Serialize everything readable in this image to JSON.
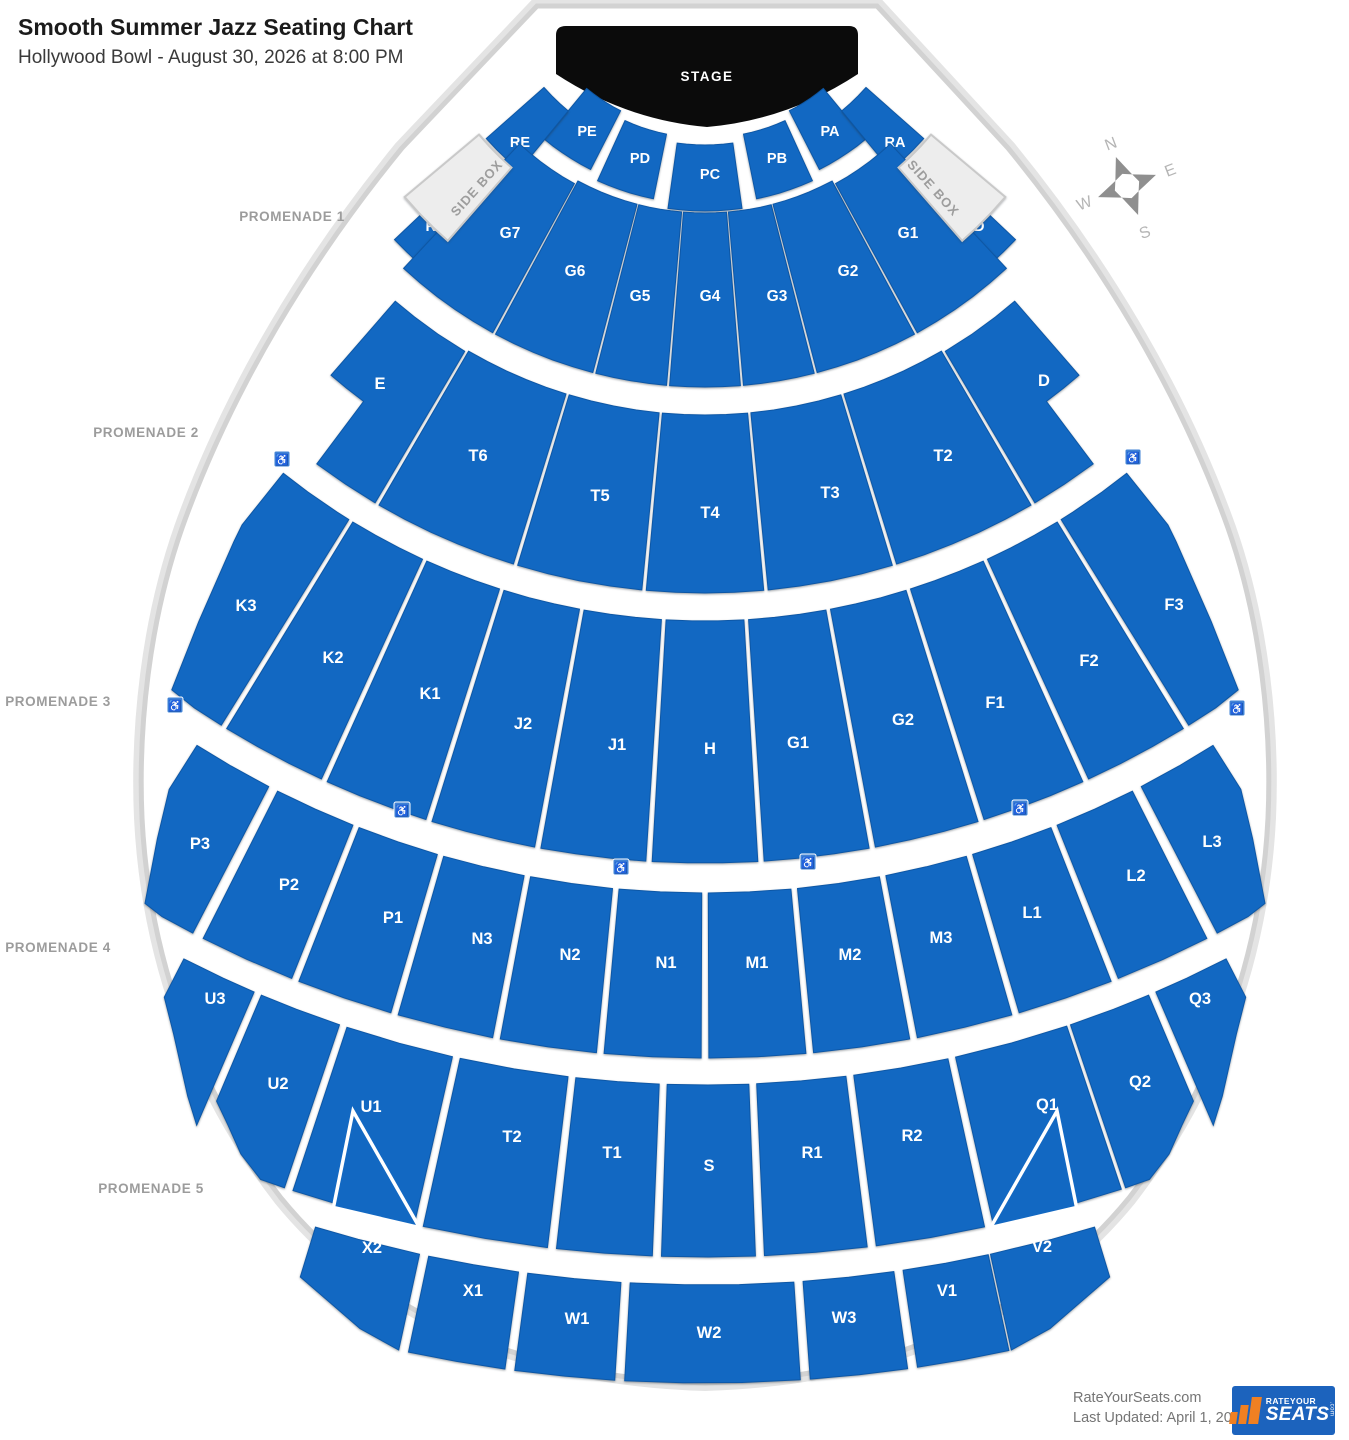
{
  "header": {
    "title": "Smooth Summer Jazz Seating Chart",
    "subtitle": "Hollywood Bowl - August 30, 2026 at 8:00 PM"
  },
  "stage": {
    "label": "STAGE"
  },
  "colors": {
    "section_blue": "#1268c2",
    "section_stroke": "#0d57a6",
    "shell_stroke": "#d2d2d2",
    "sidebox_fill": "#ededed",
    "label_white": "#ffffff",
    "promenade_text": "#9c9c9c",
    "accessible_blue": "#4083d6",
    "stage_black": "#0b0b0b",
    "logo_blue": "#1c63bd",
    "logo_orange": "#f08022"
  },
  "geometry": {
    "cx": 705,
    "cy": -55
  },
  "promenades": [
    {
      "label": "PROMENADE 1",
      "x": 292,
      "y": 221
    },
    {
      "label": "PROMENADE 2",
      "x": 146,
      "y": 437
    },
    {
      "label": "PROMENADE 3",
      "x": 58,
      "y": 706
    },
    {
      "label": "PROMENADE 4",
      "x": 58,
      "y": 952
    },
    {
      "label": "PROMENADE 5",
      "x": 151,
      "y": 1193
    }
  ],
  "compass": {
    "x": 1127,
    "y": 186,
    "rotation": -21,
    "letters": {
      "n": "N",
      "e": "E",
      "s": "S",
      "w": "W"
    }
  },
  "footer": {
    "site": "RateYourSeats.com",
    "updated": "Last Updated: April 1, 2026",
    "logo": {
      "top": "RATEYOUR",
      "main": "SEATS",
      "com": ".com"
    }
  },
  "side_boxes": [
    {
      "name": "side-box-left",
      "label": "SIDE BOX",
      "t0": 50,
      "t1": 41,
      "r0": 295,
      "r1": 392,
      "lx": 480,
      "ly": 191,
      "rot": -48
    },
    {
      "name": "side-box-right",
      "label": "SIDE BOX",
      "t0": -41,
      "t1": -50,
      "r0": 295,
      "r1": 392,
      "lx": 930,
      "ly": 191,
      "rot": 48
    }
  ],
  "sections": [
    {
      "name": "PE",
      "label": "PE",
      "t0": 39.5,
      "t1": 27,
      "r0": 186,
      "r1": 252,
      "lx": 587,
      "ly": 136,
      "fs": 14.5
    },
    {
      "name": "PD",
      "label": "PD",
      "t0": 24.5,
      "t1": 11.5,
      "r0": 193,
      "r1": 259,
      "lx": 640,
      "ly": 163,
      "fs": 14.5
    },
    {
      "name": "PC",
      "label": "PC",
      "t0": 8,
      "t1": -8,
      "r0": 200,
      "r1": 266,
      "lx": 710,
      "ly": 179,
      "fs": 14.5
    },
    {
      "name": "PB",
      "label": "PB",
      "t0": -11.5,
      "t1": -24.5,
      "r0": 193,
      "r1": 259,
      "lx": 777,
      "ly": 163,
      "fs": 14.5
    },
    {
      "name": "PA",
      "label": "PA",
      "t0": -27,
      "t1": -39.5,
      "r0": 186,
      "r1": 252,
      "lx": 830,
      "ly": 136,
      "fs": 14.5
    },
    {
      "name": "RE",
      "label": "RE",
      "t0": 48.5,
      "t1": 39.5,
      "r0": 215,
      "r1": 292,
      "lx": 520,
      "ly": 147,
      "fs": 14.5
    },
    {
      "name": "RA",
      "label": "RA",
      "t0": -39.5,
      "t1": -48.5,
      "r0": 215,
      "r1": 292,
      "lx": 895,
      "ly": 147,
      "fs": 14.5
    },
    {
      "name": "RH",
      "label": "RH",
      "t0": 46.5,
      "t1": 39.5,
      "r0": 372,
      "r1": 428,
      "lx": 436,
      "ly": 231,
      "fs": 14.5
    },
    {
      "name": "RD",
      "label": "RD",
      "t0": -39.5,
      "t1": -46.5,
      "r0": 372,
      "r1": 428,
      "lx": 974,
      "ly": 231,
      "fs": 14.5
    },
    {
      "name": "G7",
      "label": "G7",
      "t0": 43,
      "t1": 28.7,
      "r0": 272,
      "r1": 442,
      "lx": 510,
      "ly": 238,
      "fs": 15.5
    },
    {
      "name": "G6",
      "label": "G6",
      "t0": 28.3,
      "t1": 14.7,
      "r0": 268,
      "r1": 442,
      "lx": 575,
      "ly": 276,
      "fs": 15.5
    },
    {
      "name": "G5",
      "label": "G5",
      "t0": 14.3,
      "t1": 5.0,
      "r0": 268,
      "r1": 442,
      "lx": 640,
      "ly": 301,
      "fs": 15.5
    },
    {
      "name": "G4",
      "label": "G4",
      "t0": 4.6,
      "t1": -4.6,
      "r0": 268,
      "r1": 442,
      "lx": 710,
      "ly": 301,
      "fs": 15.5
    },
    {
      "name": "G3",
      "label": "G3",
      "t0": -5.0,
      "t1": -14.3,
      "r0": 268,
      "r1": 442,
      "lx": 777,
      "ly": 301,
      "fs": 15.5
    },
    {
      "name": "G2",
      "label": "G2",
      "t0": -14.7,
      "t1": -28.3,
      "r0": 268,
      "r1": 442,
      "lx": 848,
      "ly": 276,
      "fs": 15.5
    },
    {
      "name": "G1",
      "label": "G1",
      "t0": -28.7,
      "t1": -43,
      "r0": 272,
      "r1": 442,
      "lx": 908,
      "ly": 238,
      "fs": 15.5
    },
    {
      "name": "E",
      "label": "E",
      "pts": [
        [
          41,
          472
        ],
        [
          38,
          472
        ],
        [
          34.5,
          472
        ],
        [
          30.6,
          472
        ],
        [
          30.6,
          648
        ],
        [
          33.7,
          648
        ],
        [
          36.8,
          648
        ],
        [
          36.8,
          570
        ],
        [
          39,
          570
        ],
        [
          41,
          570
        ]
      ],
      "lx": 380,
      "ly": 389,
      "fs": 16.5
    },
    {
      "name": "T6",
      "label": "T6",
      "t0": 30.2,
      "t1": 17.2,
      "r0": 470,
      "r1": 648,
      "lx": 478,
      "ly": 461,
      "fs": 16.5
    },
    {
      "name": "T5",
      "label": "T5",
      "t0": 16.8,
      "t1": 5.6,
      "r0": 470,
      "r1": 648,
      "lx": 600,
      "ly": 501,
      "fs": 16.5
    },
    {
      "name": "T4",
      "label": "T4",
      "t0": 5.2,
      "t1": -5.2,
      "r0": 470,
      "r1": 648,
      "lx": 710,
      "ly": 518,
      "fs": 16.5
    },
    {
      "name": "T3",
      "label": "T3",
      "t0": -5.6,
      "t1": -16.8,
      "r0": 470,
      "r1": 648,
      "lx": 830,
      "ly": 498,
      "fs": 16.5
    },
    {
      "name": "T2",
      "label": "T2",
      "t0": -17.2,
      "t1": -30.2,
      "r0": 470,
      "r1": 648,
      "lx": 943,
      "ly": 461,
      "fs": 16.5
    },
    {
      "name": "D",
      "label": "D",
      "pts": [
        [
          -30.6,
          472
        ],
        [
          -34.5,
          472
        ],
        [
          -38,
          472
        ],
        [
          -41,
          472
        ],
        [
          -41,
          570
        ],
        [
          -39,
          570
        ],
        [
          -36.8,
          570
        ],
        [
          -36.8,
          648
        ],
        [
          -33.7,
          648
        ],
        [
          -30.6,
          648
        ]
      ],
      "lx": 1044,
      "ly": 386,
      "fs": 16.5
    },
    {
      "name": "K3",
      "label": "K3",
      "pts": [
        [
          38.6,
          676
        ],
        [
          36,
          676
        ],
        [
          33,
          676
        ],
        [
          31.8,
          676
        ],
        [
          31.8,
          918
        ],
        [
          33.8,
          918
        ],
        [
          35.6,
          916
        ],
        [
          36.8,
          845
        ],
        [
          38.3,
          760
        ],
        [
          38.6,
          742
        ]
      ],
      "lx": 246,
      "ly": 611,
      "fs": 16.5
    },
    {
      "name": "K2",
      "label": "K2",
      "t0": 31.4,
      "t1": 24.7,
      "r0": 676,
      "r1": 918,
      "lx": 333,
      "ly": 663,
      "fs": 16.5
    },
    {
      "name": "K1",
      "label": "K1",
      "t0": 24.3,
      "t1": 17.7,
      "r0": 676,
      "r1": 918,
      "lx": 430,
      "ly": 699,
      "fs": 16.5
    },
    {
      "name": "J2",
      "label": "J2",
      "t0": 17.3,
      "t1": 10.7,
      "r0": 676,
      "r1": 918,
      "lx": 523,
      "ly": 729,
      "fs": 16.5
    },
    {
      "name": "J1",
      "label": "J1",
      "t0": 10.3,
      "t1": 3.7,
      "r0": 676,
      "r1": 918,
      "lx": 617,
      "ly": 750,
      "fs": 16.5
    },
    {
      "name": "H",
      "label": "H",
      "t0": 3.3,
      "t1": -3.3,
      "r0": 676,
      "r1": 918,
      "lx": 710,
      "ly": 754,
      "fs": 16.5
    },
    {
      "name": "G1-middle",
      "label": "G1",
      "t0": -3.7,
      "t1": -10.3,
      "r0": 676,
      "r1": 918,
      "lx": 798,
      "ly": 748,
      "fs": 16.5
    },
    {
      "name": "G2-middle",
      "label": "G2",
      "t0": -10.7,
      "t1": -17.3,
      "r0": 676,
      "r1": 918,
      "lx": 903,
      "ly": 725,
      "fs": 16.5
    },
    {
      "name": "F1",
      "label": "F1",
      "t0": -17.7,
      "t1": -24.3,
      "r0": 676,
      "r1": 918,
      "lx": 995,
      "ly": 708,
      "fs": 16.5
    },
    {
      "name": "F2",
      "label": "F2",
      "t0": -24.7,
      "t1": -31.4,
      "r0": 676,
      "r1": 918,
      "lx": 1089,
      "ly": 666,
      "fs": 16.5
    },
    {
      "name": "F3",
      "label": "F3",
      "pts": [
        [
          -31.8,
          676
        ],
        [
          -33,
          676
        ],
        [
          -36,
          676
        ],
        [
          -38.6,
          676
        ],
        [
          -38.6,
          742
        ],
        [
          -38.3,
          760
        ],
        [
          -36.8,
          845
        ],
        [
          -35.6,
          916
        ],
        [
          -33.8,
          918
        ],
        [
          -31.8,
          918
        ]
      ],
      "lx": 1174,
      "ly": 610,
      "fs": 16.5
    },
    {
      "name": "P3",
      "label": "P3",
      "pts": [
        [
          32.4,
          948
        ],
        [
          30,
          948
        ],
        [
          27.4,
          948
        ],
        [
          27.4,
          1113
        ],
        [
          29.2,
          1113
        ],
        [
          30.3,
          1110
        ],
        [
          31.5,
          1048
        ],
        [
          32.4,
          1000
        ]
      ],
      "lx": 200,
      "ly": 849,
      "fs": 16.5
    },
    {
      "name": "P2",
      "label": "P2",
      "t0": 26.8,
      "t1": 21.8,
      "r0": 948,
      "r1": 1113,
      "lx": 289,
      "ly": 890,
      "fs": 16.5
    },
    {
      "name": "P1",
      "label": "P1",
      "t0": 21.4,
      "t1": 16.4,
      "r0": 948,
      "r1": 1113,
      "lx": 393,
      "ly": 923,
      "fs": 16.5
    },
    {
      "name": "N3",
      "label": "N3",
      "t0": 16.0,
      "t1": 11.0,
      "r0": 948,
      "r1": 1113,
      "lx": 482,
      "ly": 944,
      "fs": 16.5
    },
    {
      "name": "N2",
      "label": "N2",
      "t0": 10.6,
      "t1": 5.6,
      "r0": 948,
      "r1": 1113,
      "lx": 570,
      "ly": 960,
      "fs": 16.5
    },
    {
      "name": "N1",
      "label": "N1",
      "t0": 5.2,
      "t1": 0.2,
      "r0": 948,
      "r1": 1113,
      "lx": 666,
      "ly": 968,
      "fs": 16.5
    },
    {
      "name": "M1",
      "label": "M1",
      "t0": -0.2,
      "t1": -5.2,
      "r0": 948,
      "r1": 1113,
      "lx": 757,
      "ly": 968,
      "fs": 16.5
    },
    {
      "name": "M2",
      "label": "M2",
      "t0": -5.6,
      "t1": -10.6,
      "r0": 948,
      "r1": 1113,
      "lx": 850,
      "ly": 960,
      "fs": 16.5
    },
    {
      "name": "M3",
      "label": "M3",
      "t0": -11.0,
      "t1": -16.0,
      "r0": 948,
      "r1": 1113,
      "lx": 941,
      "ly": 943,
      "fs": 16.5
    },
    {
      "name": "L1",
      "label": "L1",
      "t0": -16.4,
      "t1": -21.4,
      "r0": 948,
      "r1": 1113,
      "lx": 1032,
      "ly": 918,
      "fs": 16.5
    },
    {
      "name": "L2",
      "label": "L2",
      "t0": -21.8,
      "t1": -26.8,
      "r0": 948,
      "r1": 1113,
      "lx": 1136,
      "ly": 881,
      "fs": 16.5
    },
    {
      "name": "L3",
      "label": "L3",
      "pts": [
        [
          -27.4,
          948
        ],
        [
          -30,
          948
        ],
        [
          -32.4,
          948
        ],
        [
          -32.4,
          1000
        ],
        [
          -31.5,
          1048
        ],
        [
          -30.3,
          1110
        ],
        [
          -29.2,
          1113
        ],
        [
          -27.4,
          1113
        ]
      ],
      "lx": 1212,
      "ly": 847,
      "fs": 16.5
    },
    {
      "name": "U3",
      "label": "U3",
      "pts": [
        [
          27.2,
          1140
        ],
        [
          25,
          1140
        ],
        [
          23.3,
          1140
        ],
        [
          23.3,
          1285
        ],
        [
          24.2,
          1262
        ],
        [
          26,
          1212
        ],
        [
          27.2,
          1183
        ]
      ],
      "lx": 215,
      "ly": 1004,
      "fs": 16.5
    },
    {
      "name": "U2",
      "label": "U2",
      "pts": [
        [
          22.9,
          1140
        ],
        [
          21,
          1140
        ],
        [
          18.7,
          1140
        ],
        [
          18.7,
          1312
        ],
        [
          19.8,
          1312
        ],
        [
          21,
          1295
        ],
        [
          22,
          1273
        ],
        [
          22.9,
          1255
        ]
      ],
      "lx": 278,
      "ly": 1089,
      "fs": 16.5
    },
    {
      "name": "U1",
      "label": "U1",
      "t0": 18.3,
      "t1": 12.8,
      "r0": 1140,
      "r1": 1312,
      "lx": 371,
      "ly": 1112,
      "fs": 16.5
    },
    {
      "name": "T2-lower",
      "label": "T2",
      "t0": 12.4,
      "t1": 6.9,
      "r0": 1140,
      "r1": 1312,
      "lx": 512,
      "ly": 1142,
      "fs": 16.5
    },
    {
      "name": "T1",
      "label": "T1",
      "t0": 6.5,
      "t1": 2.3,
      "r0": 1140,
      "r1": 1312,
      "lx": 612,
      "ly": 1158,
      "fs": 16.5
    },
    {
      "name": "S",
      "label": "S",
      "t0": 1.9,
      "t1": -2.2,
      "r0": 1140,
      "r1": 1312,
      "lx": 709,
      "ly": 1171,
      "fs": 16.5
    },
    {
      "name": "R1",
      "label": "R1",
      "t0": -2.6,
      "t1": -7.1,
      "r0": 1140,
      "r1": 1312,
      "lx": 812,
      "ly": 1158,
      "fs": 16.5
    },
    {
      "name": "R2",
      "label": "R2",
      "t0": -7.5,
      "t1": -12.3,
      "r0": 1140,
      "r1": 1312,
      "lx": 912,
      "ly": 1141,
      "fs": 16.5
    },
    {
      "name": "Q1",
      "label": "Q1",
      "t0": -12.7,
      "t1": -18.5,
      "r0": 1140,
      "r1": 1312,
      "lx": 1047,
      "ly": 1110,
      "fs": 16.5
    },
    {
      "name": "Q2",
      "label": "Q2",
      "pts": [
        [
          -18.7,
          1140
        ],
        [
          -21,
          1140
        ],
        [
          -22.9,
          1140
        ],
        [
          -22.9,
          1255
        ],
        [
          -22,
          1273
        ],
        [
          -21,
          1295
        ],
        [
          -19.8,
          1312
        ],
        [
          -18.7,
          1312
        ]
      ],
      "lx": 1140,
      "ly": 1087,
      "fs": 16.5
    },
    {
      "name": "Q3",
      "label": "Q3",
      "pts": [
        [
          -23.3,
          1140
        ],
        [
          -25,
          1140
        ],
        [
          -27.2,
          1140
        ],
        [
          -27.2,
          1183
        ],
        [
          -26,
          1212
        ],
        [
          -24.2,
          1262
        ],
        [
          -23.3,
          1285
        ]
      ],
      "lx": 1200,
      "ly": 1004,
      "fs": 16.5
    },
    {
      "name": "X2",
      "label": "X2",
      "pts": [
        [
          16.9,
          1340
        ],
        [
          15,
          1340
        ],
        [
          12.3,
          1340
        ],
        [
          12.3,
          1438
        ],
        [
          14,
          1426
        ],
        [
          16,
          1402
        ],
        [
          16.9,
          1392
        ]
      ],
      "lx": 372,
      "ly": 1253,
      "fs": 16.5
    },
    {
      "name": "X1",
      "label": "X1",
      "t0": 11.9,
      "t1": 8.0,
      "r0": 1340,
      "r1": 1438,
      "lx": 473,
      "ly": 1296,
      "fs": 16.5
    },
    {
      "name": "W1",
      "label": "W1",
      "t0": 7.6,
      "t1": 3.6,
      "r0": 1340,
      "r1": 1438,
      "lx": 577,
      "ly": 1324,
      "fs": 16.5
    },
    {
      "name": "W2",
      "label": "W2",
      "t0": 3.2,
      "t1": -3.8,
      "r0": 1340,
      "r1": 1438,
      "lx": 709,
      "ly": 1338,
      "fs": 16.5
    },
    {
      "name": "W3",
      "label": "W3",
      "t0": -4.2,
      "t1": -8.1,
      "r0": 1340,
      "r1": 1438,
      "lx": 844,
      "ly": 1323,
      "fs": 16.5
    },
    {
      "name": "V1",
      "label": "V1",
      "t0": -8.5,
      "t1": -12.2,
      "r0": 1340,
      "r1": 1438,
      "lx": 947,
      "ly": 1296,
      "fs": 16.5
    },
    {
      "name": "V2",
      "label": "V2",
      "pts": [
        [
          -12.3,
          1340
        ],
        [
          -15,
          1340
        ],
        [
          -16.9,
          1340
        ],
        [
          -16.9,
          1392
        ],
        [
          -16,
          1402
        ],
        [
          -14,
          1426
        ],
        [
          -12.3,
          1438
        ]
      ],
      "lx": 1042,
      "ly": 1252,
      "fs": 16.5
    }
  ],
  "unlabeled_notches": [
    {
      "name": "notch-u1",
      "pts": [
        [
          16.8,
          1218
        ],
        [
          16.4,
          1316
        ],
        [
          12.55,
          1314
        ]
      ]
    },
    {
      "name": "notch-q1",
      "pts": [
        [
          -16.8,
          1218
        ],
        [
          -16.4,
          1316
        ],
        [
          -12.55,
          1314
        ]
      ]
    }
  ],
  "accessible_seating_icons": [
    {
      "x": 282,
      "y": 459
    },
    {
      "x": 1133,
      "y": 457
    },
    {
      "x": 175,
      "y": 705
    },
    {
      "x": 1237,
      "y": 708
    },
    {
      "x": 402,
      "y": 810
    },
    {
      "x": 1020,
      "y": 808
    },
    {
      "x": 621,
      "y": 867
    },
    {
      "x": 808,
      "y": 862
    }
  ]
}
